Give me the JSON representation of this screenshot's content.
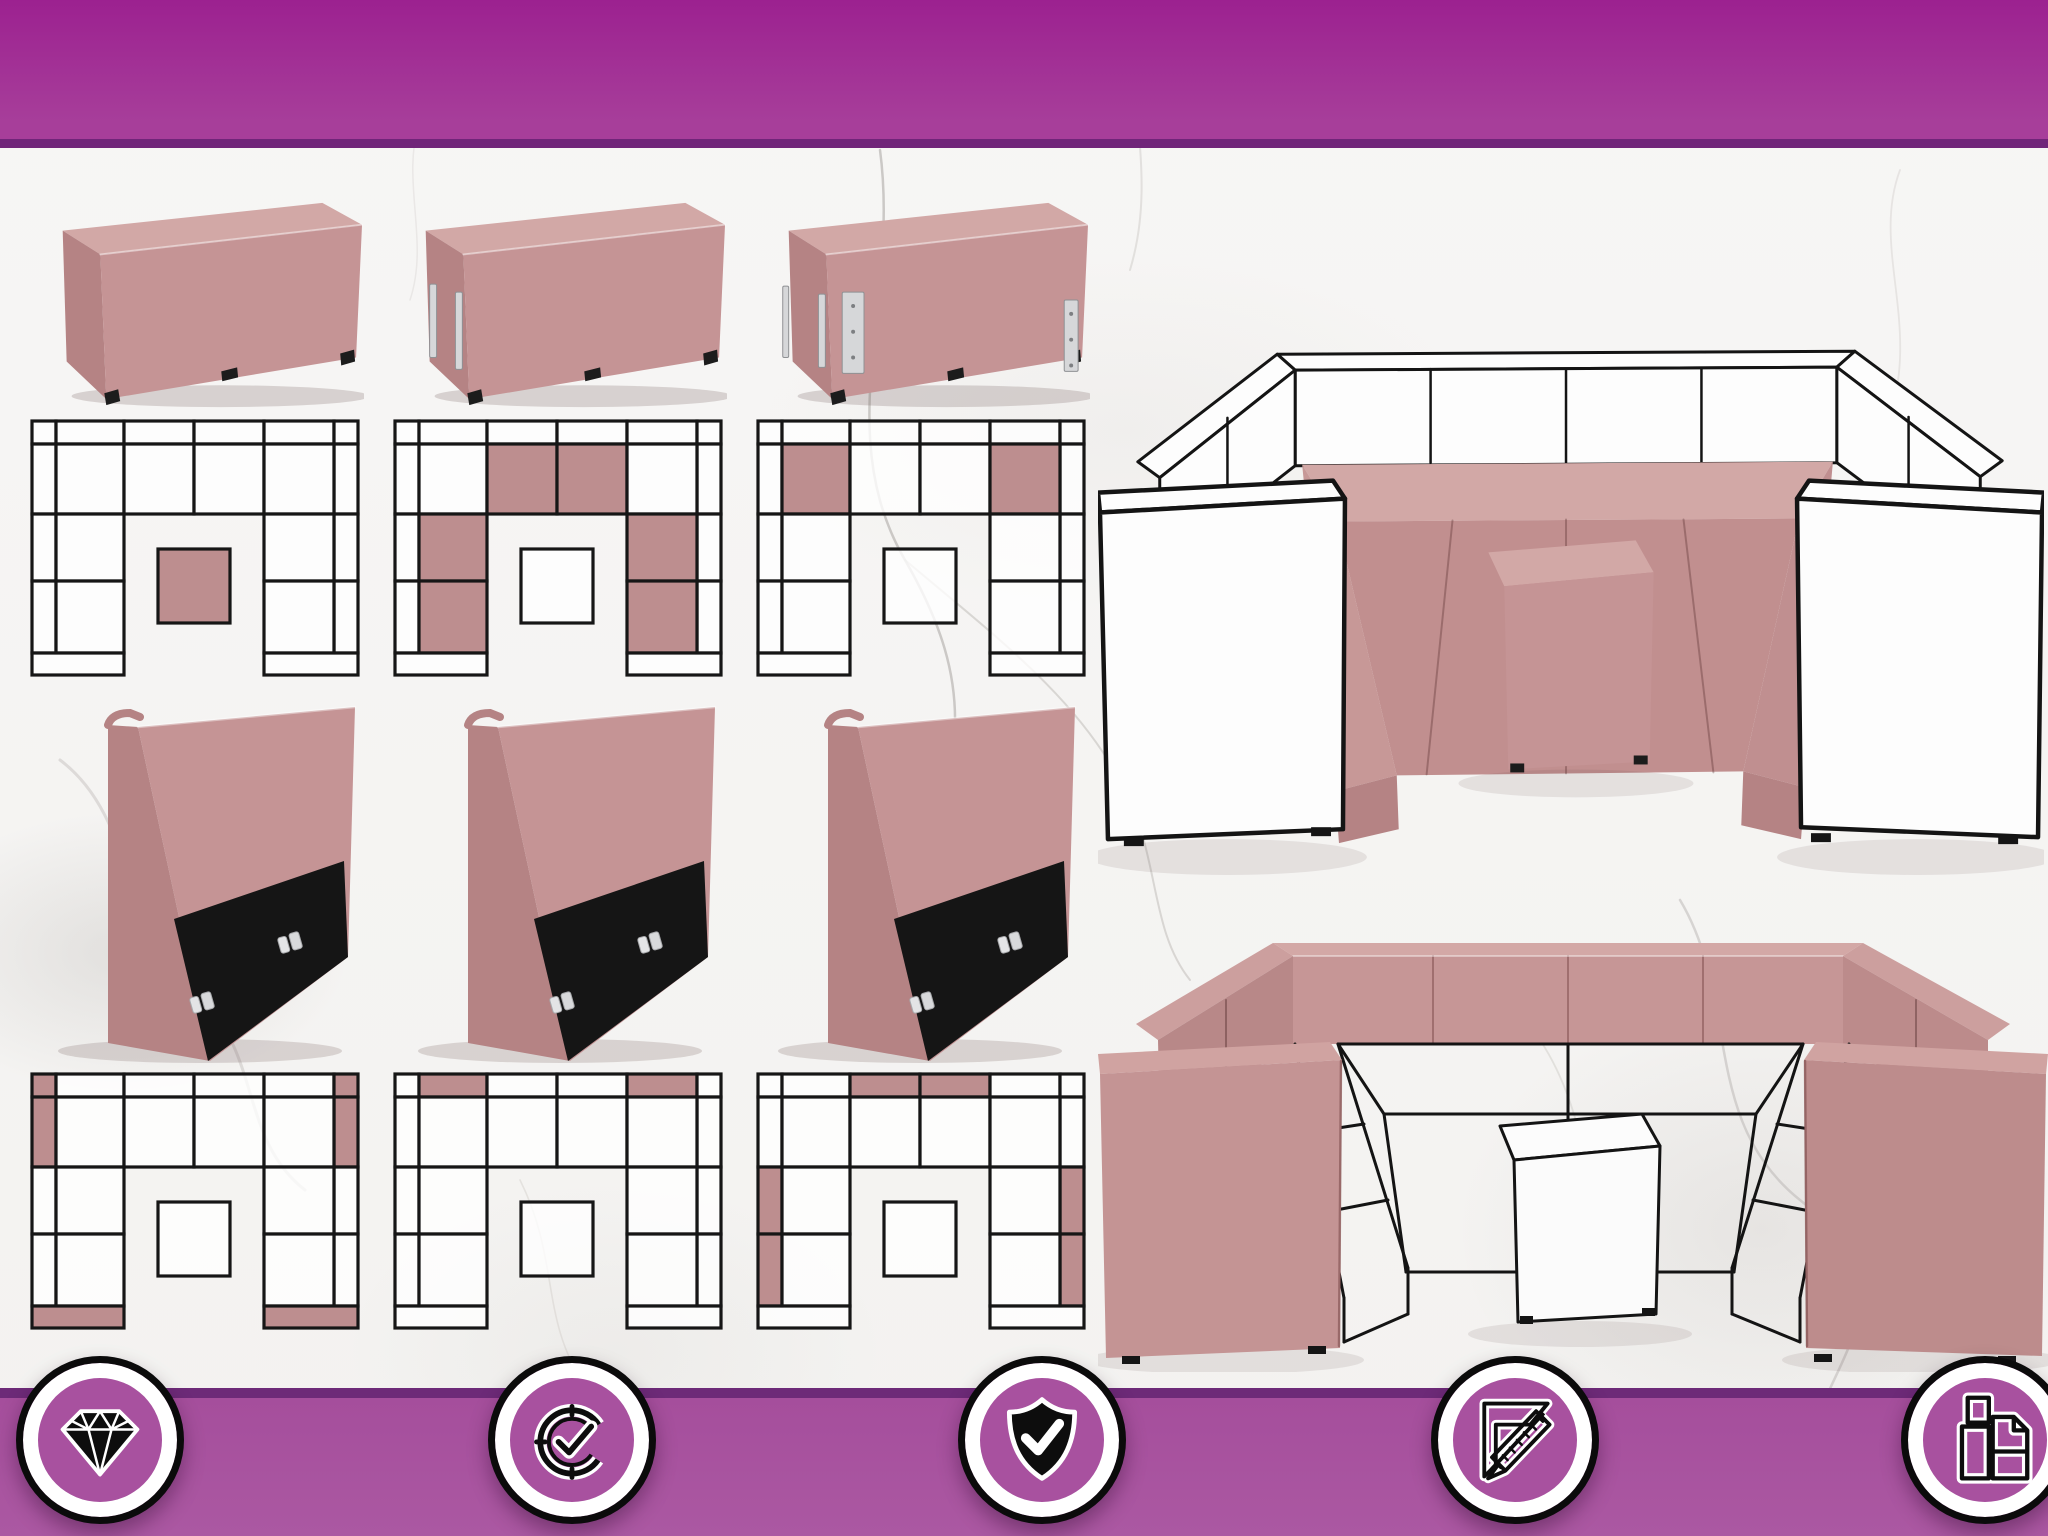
{
  "theme": {
    "banner_magenta_top": "#9c2190",
    "banner_magenta_bottom_bar": "#a8519f",
    "banner_line_purple": "#702579",
    "fabric_pink": "#c59495",
    "fabric_pink_light": "#d2a8a6",
    "fabric_pink_dark": "#b58384",
    "diagram_fill_pink": "#bd8e8f",
    "diagram_fill_white": "rgba(255,255,255,0.78)",
    "diagram_line": "#161616",
    "panel_black": "#151515",
    "metal": "#d6d7d9",
    "outline_ink": "#141414",
    "background_marble": "#f5f4f2"
  },
  "modules": [
    {
      "id": "pouf-table-module",
      "photo": "ottoman",
      "hardware": "none",
      "diagram_highlights": [
        "table"
      ]
    },
    {
      "id": "seat-middle-module",
      "photo": "ottoman",
      "hardware": "left-edges",
      "diagram_highlights": [
        "seat-2",
        "seat-3",
        "larm-1",
        "larm-2",
        "rarm-1",
        "rarm-2"
      ]
    },
    {
      "id": "seat-corner-module",
      "photo": "ottoman",
      "hardware": "corner",
      "diagram_highlights": [
        "seat-1",
        "seat-4"
      ]
    },
    {
      "id": "end-panel-module",
      "photo": "backrest",
      "hardware": "clips",
      "diagram_highlights": [
        "tl-corner",
        "left-tall",
        "tr-corner",
        "right-tall",
        "foot-l",
        "foot-r"
      ]
    },
    {
      "id": "backrest-top-module",
      "photo": "backrest",
      "hardware": "clips",
      "diagram_highlights": [
        "top-1",
        "top-4"
      ]
    },
    {
      "id": "backrest-side-module",
      "photo": "backrest",
      "hardware": "clips",
      "diagram_highlights": [
        "top-2",
        "top-3",
        "left-mid",
        "left-low",
        "right-mid",
        "right-low"
      ]
    }
  ],
  "renders": [
    {
      "id": "sofa-render-outline-frame",
      "style": "outline",
      "description_icon": "u-shaped-sofa-white-frame-pink-seats"
    },
    {
      "id": "sofa-render-pink-frame",
      "style": "pink",
      "description_icon": "u-shaped-sofa-pink-frame-wireframe-seats"
    }
  ],
  "badges": [
    {
      "id": "badge-premium-quality",
      "icon": "diamond-icon"
    },
    {
      "id": "badge-long-lasting",
      "icon": "clock-check-icon"
    },
    {
      "id": "badge-guarantee",
      "icon": "shield-check-icon"
    },
    {
      "id": "badge-made-to-measure",
      "icon": "ruler-pencil-icon"
    },
    {
      "id": "badge-modular-design",
      "icon": "furniture-modules-icon"
    }
  ]
}
